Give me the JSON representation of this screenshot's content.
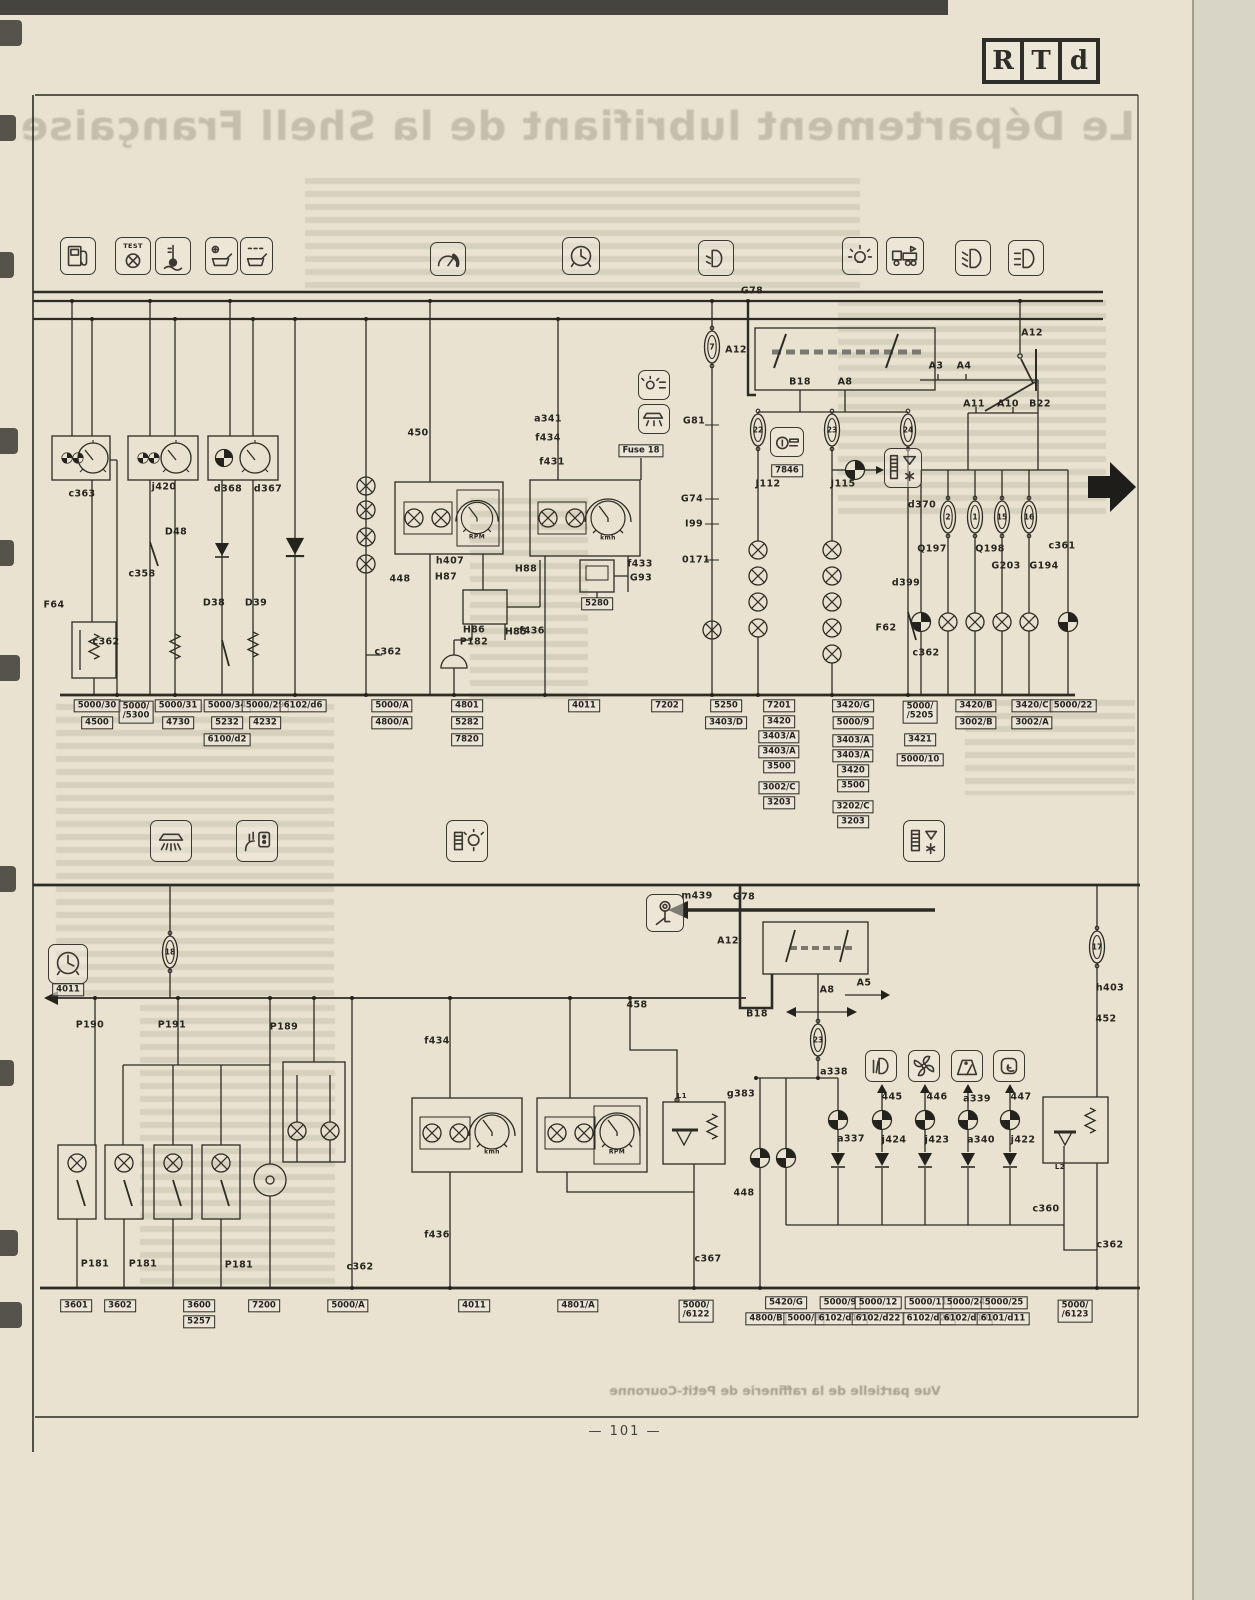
{
  "page": {
    "number": "— 101 —",
    "logo": [
      "R",
      "T",
      "d"
    ]
  },
  "ghost": {
    "headline": "Le Département lubrifiant de la Shell Française",
    "caption": "Vue partielle de la raffinerie de Petit-Couronne"
  },
  "colors": {
    "paper": "#e9e2d0",
    "ink": "#2c2b25",
    "ghost_text": "#8f8a72"
  },
  "icons": {
    "top_row": [
      "fuel-pump-icon",
      "diagnostic-test-icon",
      "coolant-temperature-icon",
      "oil-level-icon",
      "oil-pressure-icon",
      "tachometer-icon",
      "clock-icon",
      "headlight-flash-icon",
      "bulb-icon",
      "truck-trailer-icon",
      "low-beam-icon",
      "high-beam-icon"
    ],
    "middle_row": [
      "ceiling-light-icon",
      "power-socket-icon",
      "battery-bulb-icon",
      "heater-indicator-icon"
    ],
    "in_diagram": [
      "instrument-light-icon",
      "dome-light-icon",
      "cigarette-lighter-icon",
      "heater-box-icon",
      "ignition-key-icon",
      "dash-clock-icon",
      "fog-light-icon",
      "fan-icon",
      "wiper-icon",
      "defrost-icon"
    ]
  },
  "schematic": {
    "wire_labels": [
      {
        "t": "G78",
        "x": 752,
        "y": 291
      },
      {
        "t": "A12",
        "x": 1032,
        "y": 333
      },
      {
        "t": "A3",
        "x": 936,
        "y": 366
      },
      {
        "t": "A4",
        "x": 964,
        "y": 366
      },
      {
        "t": "A11",
        "x": 974,
        "y": 404
      },
      {
        "t": "A10",
        "x": 1008,
        "y": 404
      },
      {
        "t": "B22",
        "x": 1040,
        "y": 404
      },
      {
        "t": "A12",
        "x": 736,
        "y": 350
      },
      {
        "t": "B18",
        "x": 800,
        "y": 382
      },
      {
        "t": "A8",
        "x": 845,
        "y": 382
      },
      {
        "t": "J112",
        "x": 768,
        "y": 484
      },
      {
        "t": "J115",
        "x": 843,
        "y": 484
      },
      {
        "t": "G81",
        "x": 694,
        "y": 421
      },
      {
        "t": "G74",
        "x": 692,
        "y": 499
      },
      {
        "t": "I99",
        "x": 694,
        "y": 524
      },
      {
        "t": "0171",
        "x": 696,
        "y": 560
      },
      {
        "t": "d370",
        "x": 922,
        "y": 505
      },
      {
        "t": "d399",
        "x": 906,
        "y": 583
      },
      {
        "t": "F62",
        "x": 886,
        "y": 628
      },
      {
        "t": "c362",
        "x": 926,
        "y": 653
      },
      {
        "t": "Q197",
        "x": 932,
        "y": 549
      },
      {
        "t": "Q198",
        "x": 990,
        "y": 549
      },
      {
        "t": "G203",
        "x": 1006,
        "y": 566
      },
      {
        "t": "G194",
        "x": 1044,
        "y": 566
      },
      {
        "t": "c361",
        "x": 1062,
        "y": 546
      },
      {
        "t": "c363",
        "x": 82,
        "y": 494
      },
      {
        "t": "j420",
        "x": 164,
        "y": 487
      },
      {
        "t": "d368",
        "x": 228,
        "y": 489
      },
      {
        "t": "d367",
        "x": 268,
        "y": 489
      },
      {
        "t": "D48",
        "x": 176,
        "y": 532
      },
      {
        "t": "c358",
        "x": 142,
        "y": 574
      },
      {
        "t": "F64",
        "x": 54,
        "y": 605
      },
      {
        "t": "D38",
        "x": 214,
        "y": 603
      },
      {
        "t": "D39",
        "x": 256,
        "y": 603
      },
      {
        "t": "c362",
        "x": 106,
        "y": 642
      },
      {
        "t": "450",
        "x": 418,
        "y": 433
      },
      {
        "t": "448",
        "x": 400,
        "y": 579
      },
      {
        "t": "h407",
        "x": 450,
        "y": 561
      },
      {
        "t": "H87",
        "x": 446,
        "y": 577
      },
      {
        "t": "H88",
        "x": 526,
        "y": 569
      },
      {
        "t": "H86",
        "x": 474,
        "y": 630
      },
      {
        "t": "P182",
        "x": 474,
        "y": 642
      },
      {
        "t": "H85",
        "x": 516,
        "y": 632
      },
      {
        "t": "c362",
        "x": 388,
        "y": 652
      },
      {
        "t": "a341",
        "x": 548,
        "y": 419
      },
      {
        "t": "f434",
        "x": 548,
        "y": 438
      },
      {
        "t": "f431",
        "x": 552,
        "y": 462
      },
      {
        "t": "f433",
        "x": 640,
        "y": 564
      },
      {
        "t": "G93",
        "x": 641,
        "y": 578
      },
      {
        "t": "f436",
        "x": 532,
        "y": 631
      },
      {
        "t": "RPM",
        "x": 477,
        "y": 537,
        "s": 6
      },
      {
        "t": "kmh",
        "x": 608,
        "y": 538,
        "s": 6
      },
      {
        "t": "TEST",
        "x": 133,
        "y": 246,
        "s": 6.5
      },
      {
        "t": "m439",
        "x": 697,
        "y": 896
      },
      {
        "t": "G78",
        "x": 744,
        "y": 897
      },
      {
        "t": "A12",
        "x": 728,
        "y": 941
      },
      {
        "t": "B18",
        "x": 757,
        "y": 1014
      },
      {
        "t": "A8",
        "x": 827,
        "y": 990
      },
      {
        "t": "A5",
        "x": 864,
        "y": 983
      },
      {
        "t": "P190",
        "x": 90,
        "y": 1025
      },
      {
        "t": "P191",
        "x": 172,
        "y": 1025
      },
      {
        "t": "P189",
        "x": 284,
        "y": 1027
      },
      {
        "t": "458",
        "x": 637,
        "y": 1005
      },
      {
        "t": "f434",
        "x": 437,
        "y": 1041
      },
      {
        "t": "f436",
        "x": 437,
        "y": 1235
      },
      {
        "t": "a338",
        "x": 834,
        "y": 1072
      },
      {
        "t": "g383",
        "x": 741,
        "y": 1094
      },
      {
        "t": "448",
        "x": 744,
        "y": 1193
      },
      {
        "t": "c367",
        "x": 708,
        "y": 1259
      },
      {
        "t": "c362",
        "x": 360,
        "y": 1267
      },
      {
        "t": "445",
        "x": 892,
        "y": 1097
      },
      {
        "t": "446",
        "x": 937,
        "y": 1097
      },
      {
        "t": "a339",
        "x": 977,
        "y": 1099
      },
      {
        "t": "447",
        "x": 1021,
        "y": 1097
      },
      {
        "t": "a337",
        "x": 851,
        "y": 1139
      },
      {
        "t": "j424",
        "x": 894,
        "y": 1140
      },
      {
        "t": "j423",
        "x": 937,
        "y": 1140
      },
      {
        "t": "a340",
        "x": 981,
        "y": 1140
      },
      {
        "t": "j422",
        "x": 1023,
        "y": 1140
      },
      {
        "t": "h403",
        "x": 1110,
        "y": 988
      },
      {
        "t": "452",
        "x": 1106,
        "y": 1019
      },
      {
        "t": "c360",
        "x": 1046,
        "y": 1209
      },
      {
        "t": "c362",
        "x": 1110,
        "y": 1245
      },
      {
        "t": "P181",
        "x": 95,
        "y": 1264
      },
      {
        "t": "P181",
        "x": 143,
        "y": 1264
      },
      {
        "t": "P181",
        "x": 239,
        "y": 1265
      },
      {
        "t": "L1",
        "x": 682,
        "y": 1096,
        "s": 7
      },
      {
        "t": "L2",
        "x": 1060,
        "y": 1167,
        "s": 7
      },
      {
        "t": "kmh",
        "x": 492,
        "y": 1152,
        "s": 6
      },
      {
        "t": "RPM",
        "x": 617,
        "y": 1152,
        "s": 6
      }
    ],
    "fuse_numbers": [
      {
        "t": "7",
        "x": 712,
        "y": 347
      },
      {
        "t": "22",
        "x": 758,
        "y": 430
      },
      {
        "t": "23",
        "x": 832,
        "y": 430
      },
      {
        "t": "24",
        "x": 908,
        "y": 430
      },
      {
        "t": "2",
        "x": 948,
        "y": 517
      },
      {
        "t": "1",
        "x": 975,
        "y": 517
      },
      {
        "t": "15",
        "x": 1002,
        "y": 517
      },
      {
        "t": "16",
        "x": 1029,
        "y": 517
      },
      {
        "t": "18",
        "x": 170,
        "y": 952
      },
      {
        "t": "23",
        "x": 818,
        "y": 1040
      },
      {
        "t": "17",
        "x": 1097,
        "y": 947
      }
    ],
    "boxed_labels": [
      {
        "t": "Fuse 18",
        "x": 641,
        "y": 451
      },
      {
        "t": "7846",
        "x": 787,
        "y": 471
      },
      {
        "t": "5280",
        "x": 597,
        "y": 604
      },
      {
        "t": "4011",
        "x": 68,
        "y": 990
      },
      {
        "t": "5000/30",
        "x": 97,
        "y": 706
      },
      {
        "t": "4500",
        "x": 97,
        "y": 723
      },
      {
        "t": "5000/|/5300",
        "x": 136,
        "y": 712
      },
      {
        "t": "5000/31",
        "x": 178,
        "y": 706
      },
      {
        "t": "4730",
        "x": 178,
        "y": 723
      },
      {
        "t": "5000/34",
        "x": 227,
        "y": 706
      },
      {
        "t": "5232",
        "x": 227,
        "y": 723
      },
      {
        "t": "6100/d2",
        "x": 227,
        "y": 740
      },
      {
        "t": "5000/29",
        "x": 265,
        "y": 706
      },
      {
        "t": "4232",
        "x": 265,
        "y": 723
      },
      {
        "t": "6102/d6",
        "x": 303,
        "y": 706
      },
      {
        "t": "5000/A",
        "x": 392,
        "y": 706
      },
      {
        "t": "4800/A",
        "x": 392,
        "y": 723
      },
      {
        "t": "4801",
        "x": 467,
        "y": 706
      },
      {
        "t": "5282",
        "x": 467,
        "y": 723
      },
      {
        "t": "7820",
        "x": 467,
        "y": 740
      },
      {
        "t": "4011",
        "x": 584,
        "y": 706
      },
      {
        "t": "7202",
        "x": 667,
        "y": 706
      },
      {
        "t": "5250",
        "x": 726,
        "y": 706
      },
      {
        "t": "3403/D",
        "x": 726,
        "y": 723
      },
      {
        "t": "7201",
        "x": 779,
        "y": 706
      },
      {
        "t": "3420",
        "x": 779,
        "y": 722
      },
      {
        "t": "3403/A",
        "x": 779,
        "y": 737
      },
      {
        "t": "3403/A",
        "x": 779,
        "y": 752
      },
      {
        "t": "3500",
        "x": 779,
        "y": 767
      },
      {
        "t": "3002/C",
        "x": 779,
        "y": 788
      },
      {
        "t": "3203",
        "x": 779,
        "y": 803
      },
      {
        "t": "3420/G",
        "x": 853,
        "y": 706
      },
      {
        "t": "5000/9",
        "x": 853,
        "y": 723
      },
      {
        "t": "3403/A",
        "x": 853,
        "y": 741
      },
      {
        "t": "3403/A",
        "x": 853,
        "y": 756
      },
      {
        "t": "3420",
        "x": 853,
        "y": 771
      },
      {
        "t": "3500",
        "x": 853,
        "y": 786
      },
      {
        "t": "3202/C",
        "x": 853,
        "y": 807
      },
      {
        "t": "3203",
        "x": 853,
        "y": 822
      },
      {
        "t": "5000/|/5205",
        "x": 920,
        "y": 712
      },
      {
        "t": "3421",
        "x": 920,
        "y": 740
      },
      {
        "t": "5000/10",
        "x": 920,
        "y": 760
      },
      {
        "t": "3420/B",
        "x": 976,
        "y": 706
      },
      {
        "t": "3002/B",
        "x": 976,
        "y": 723
      },
      {
        "t": "3420/C",
        "x": 1032,
        "y": 706
      },
      {
        "t": "3002/A",
        "x": 1032,
        "y": 723
      },
      {
        "t": "5000/22",
        "x": 1073,
        "y": 706
      },
      {
        "t": "3601",
        "x": 76,
        "y": 1306
      },
      {
        "t": "3602",
        "x": 120,
        "y": 1306
      },
      {
        "t": "3600",
        "x": 199,
        "y": 1306
      },
      {
        "t": "5257",
        "x": 199,
        "y": 1322
      },
      {
        "t": "7200",
        "x": 264,
        "y": 1306
      },
      {
        "t": "5000/A",
        "x": 348,
        "y": 1306
      },
      {
        "t": "4011",
        "x": 474,
        "y": 1306
      },
      {
        "t": "4801/A",
        "x": 578,
        "y": 1306
      },
      {
        "t": "5000/|/6122",
        "x": 696,
        "y": 1311
      },
      {
        "t": "5420/G",
        "x": 786,
        "y": 1303
      },
      {
        "t": "4800/B",
        "x": 766,
        "y": 1319
      },
      {
        "t": "5000/B",
        "x": 804,
        "y": 1319
      },
      {
        "t": "5000/9",
        "x": 840,
        "y": 1303
      },
      {
        "t": "6102/d17",
        "x": 841,
        "y": 1319
      },
      {
        "t": "5000/12",
        "x": 878,
        "y": 1303
      },
      {
        "t": "6102/d22",
        "x": 878,
        "y": 1319
      },
      {
        "t": "5000/11",
        "x": 928,
        "y": 1303
      },
      {
        "t": "6102/d20",
        "x": 929,
        "y": 1319
      },
      {
        "t": "5000/24",
        "x": 966,
        "y": 1303
      },
      {
        "t": "6102/d19",
        "x": 966,
        "y": 1319
      },
      {
        "t": "5000/25",
        "x": 1004,
        "y": 1303
      },
      {
        "t": "6101/d11",
        "x": 1003,
        "y": 1319
      },
      {
        "t": "5000/|/6123",
        "x": 1075,
        "y": 1311
      }
    ]
  }
}
